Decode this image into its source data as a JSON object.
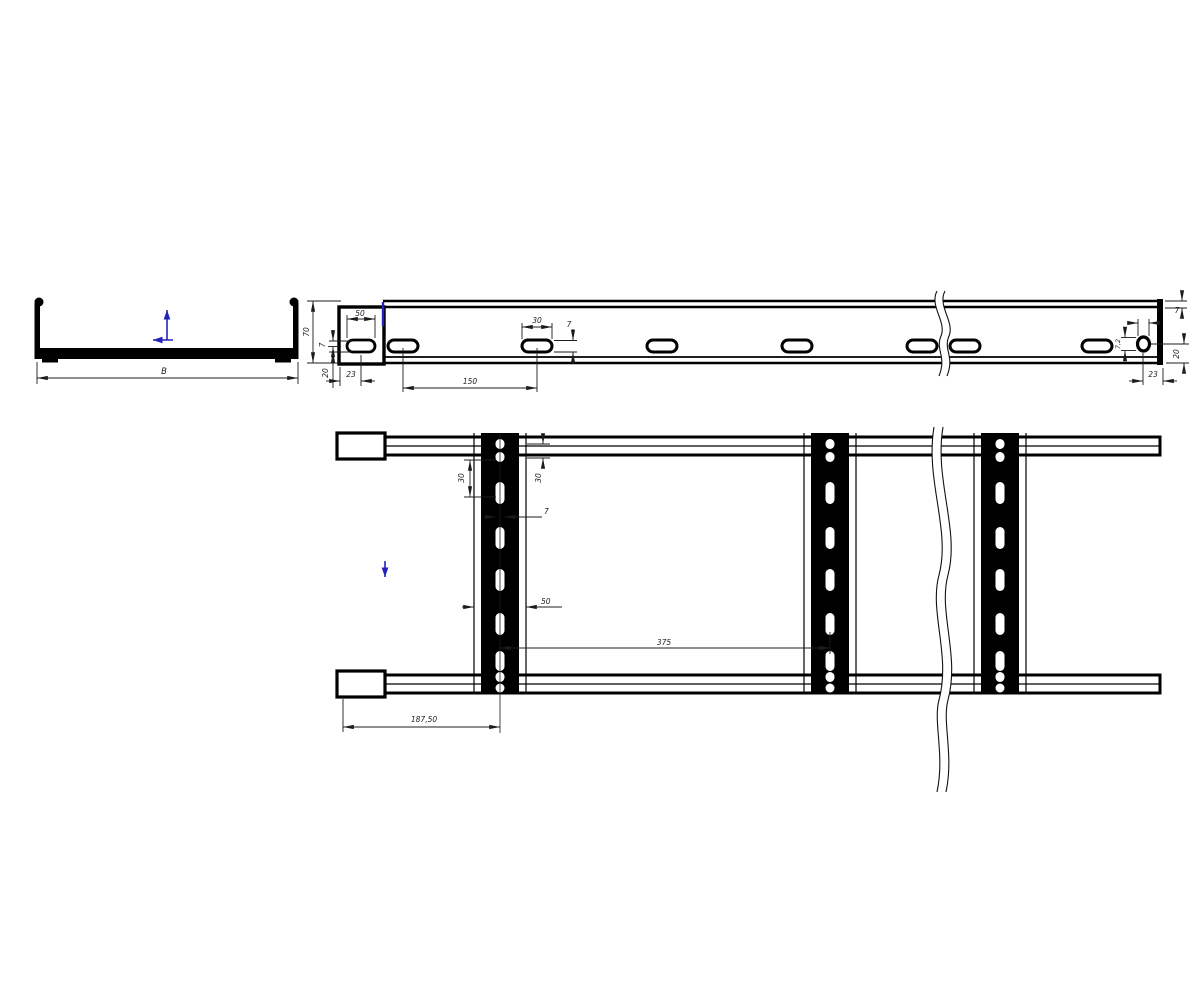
{
  "drawing": {
    "title": "cable-ladder-technical-drawing",
    "background": "#ffffff",
    "line_color": "#000000",
    "accent_color": "#2323bb",
    "cross_section": {
      "width_label": "B"
    },
    "side_view": {
      "height": "70",
      "end_slot_width": "50",
      "slot_height_left": "7",
      "bottom_offset_left": "20",
      "end_offset_left": "23",
      "slot_pitch": "150",
      "slot_width": "30",
      "slot_height": "7",
      "flange_thickness": "7",
      "hole_diameter": "7,2",
      "hole_bottom_offset": "20",
      "hole_end_offset": "23"
    },
    "plan_view": {
      "slot_pitch_left": "30",
      "slot_pitch_right": "30",
      "slot_width": "7",
      "rung_width": "50",
      "rung_pitch": "375",
      "first_rung_offset": "187,50"
    }
  }
}
